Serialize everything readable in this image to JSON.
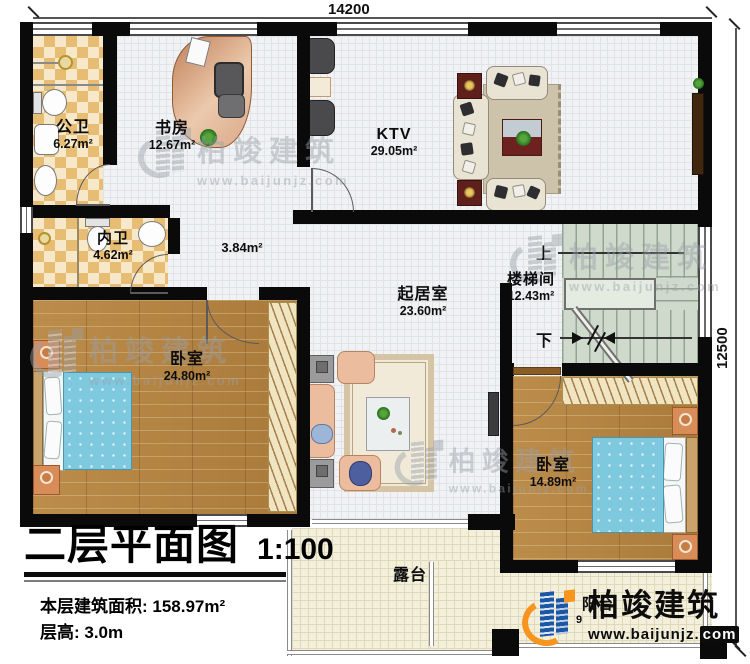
{
  "meta": {
    "plan_title": "二层平面图",
    "scale": "1:100",
    "area_total_label": "本层建筑面积: 158.97m²",
    "floor_height_label": "层高: 3.0m"
  },
  "dimensions": {
    "top": "14200",
    "right": "12500"
  },
  "rooms": {
    "gongwei": {
      "name": "公卫",
      "area": "6.27m²"
    },
    "shufang": {
      "name": "书房",
      "area": "12.67m²"
    },
    "ktv": {
      "name": "KTV",
      "area": "29.05m²"
    },
    "neiwei": {
      "name": "内卫",
      "area": "4.62m²"
    },
    "corridor": {
      "area": "3.84m²"
    },
    "qijushi": {
      "name": "起居室",
      "area": "23.60m²"
    },
    "loutijian": {
      "name": "楼梯间",
      "area": "12.43m²"
    },
    "bedroom1": {
      "name": "卧室",
      "area": "24.80m²"
    },
    "bedroom2": {
      "name": "卧室",
      "area": "14.89m²"
    },
    "lutai": {
      "name": "露台"
    },
    "yangtai": {
      "name": "阳台",
      "area": "9"
    }
  },
  "stairs": {
    "up": "上",
    "down": "下"
  },
  "brand": {
    "name": "柏竣建筑",
    "url": "www.baijunjz.com",
    "url_prefix": "www.baijunjz.",
    "url_suffix": "com"
  },
  "colors": {
    "wall": "#0a0a0a",
    "accent_blue": "#1c57a5",
    "accent_orange": "#f7941e"
  }
}
